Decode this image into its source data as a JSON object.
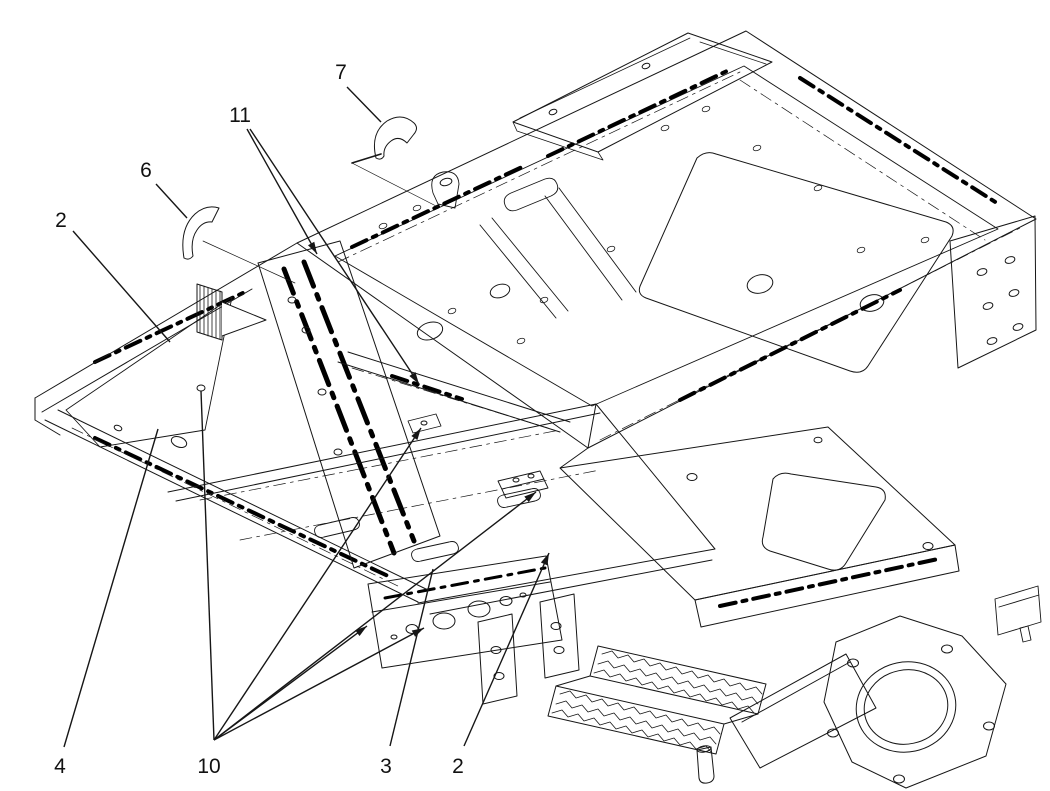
{
  "figure": {
    "background": "#ffffff",
    "line_color": "#161616",
    "tape_color": "#000000",
    "callouts": [
      {
        "id": "callout-2-top",
        "label": "2",
        "lx": 61,
        "ly": 227,
        "leaders": [
          [
            73,
            231,
            170,
            342,
            0
          ]
        ]
      },
      {
        "id": "callout-6",
        "label": "6",
        "lx": 146,
        "ly": 177,
        "leaders": [
          [
            156,
            184,
            187,
            218,
            0
          ]
        ],
        "direction_arrow": "curved-arrow"
      },
      {
        "id": "callout-7",
        "label": "7",
        "lx": 341,
        "ly": 79,
        "leaders": [
          [
            347,
            87,
            381,
            122,
            0
          ]
        ],
        "direction_arrow": "curved-arrow"
      },
      {
        "id": "callout-11",
        "label": "11",
        "lx": 240,
        "ly": 122,
        "leaders": [
          [
            247,
            129,
            317,
            254,
            1
          ],
          [
            250,
            129,
            419,
            384,
            1
          ]
        ]
      },
      {
        "id": "callout-4",
        "label": "4",
        "lx": 60,
        "ly": 773,
        "leaders": [
          [
            64,
            747,
            158,
            429,
            0
          ]
        ]
      },
      {
        "id": "callout-10",
        "label": "10",
        "lx": 209,
        "ly": 773,
        "leaders": [
          [
            214,
            740,
            201,
            391,
            0
          ],
          [
            214,
            740,
            421,
            428,
            1
          ],
          [
            214,
            740,
            536,
            492,
            1
          ],
          [
            214,
            740,
            367,
            626,
            1
          ],
          [
            214,
            740,
            424,
            628,
            1
          ]
        ]
      },
      {
        "id": "callout-3",
        "label": "3",
        "lx": 386,
        "ly": 773,
        "leaders": [
          [
            390,
            746,
            433,
            569,
            0
          ]
        ]
      },
      {
        "id": "callout-2-bottom",
        "label": "2",
        "lx": 458,
        "ly": 773,
        "leaders": [
          [
            464,
            746,
            549,
            553,
            1
          ]
        ]
      }
    ]
  }
}
